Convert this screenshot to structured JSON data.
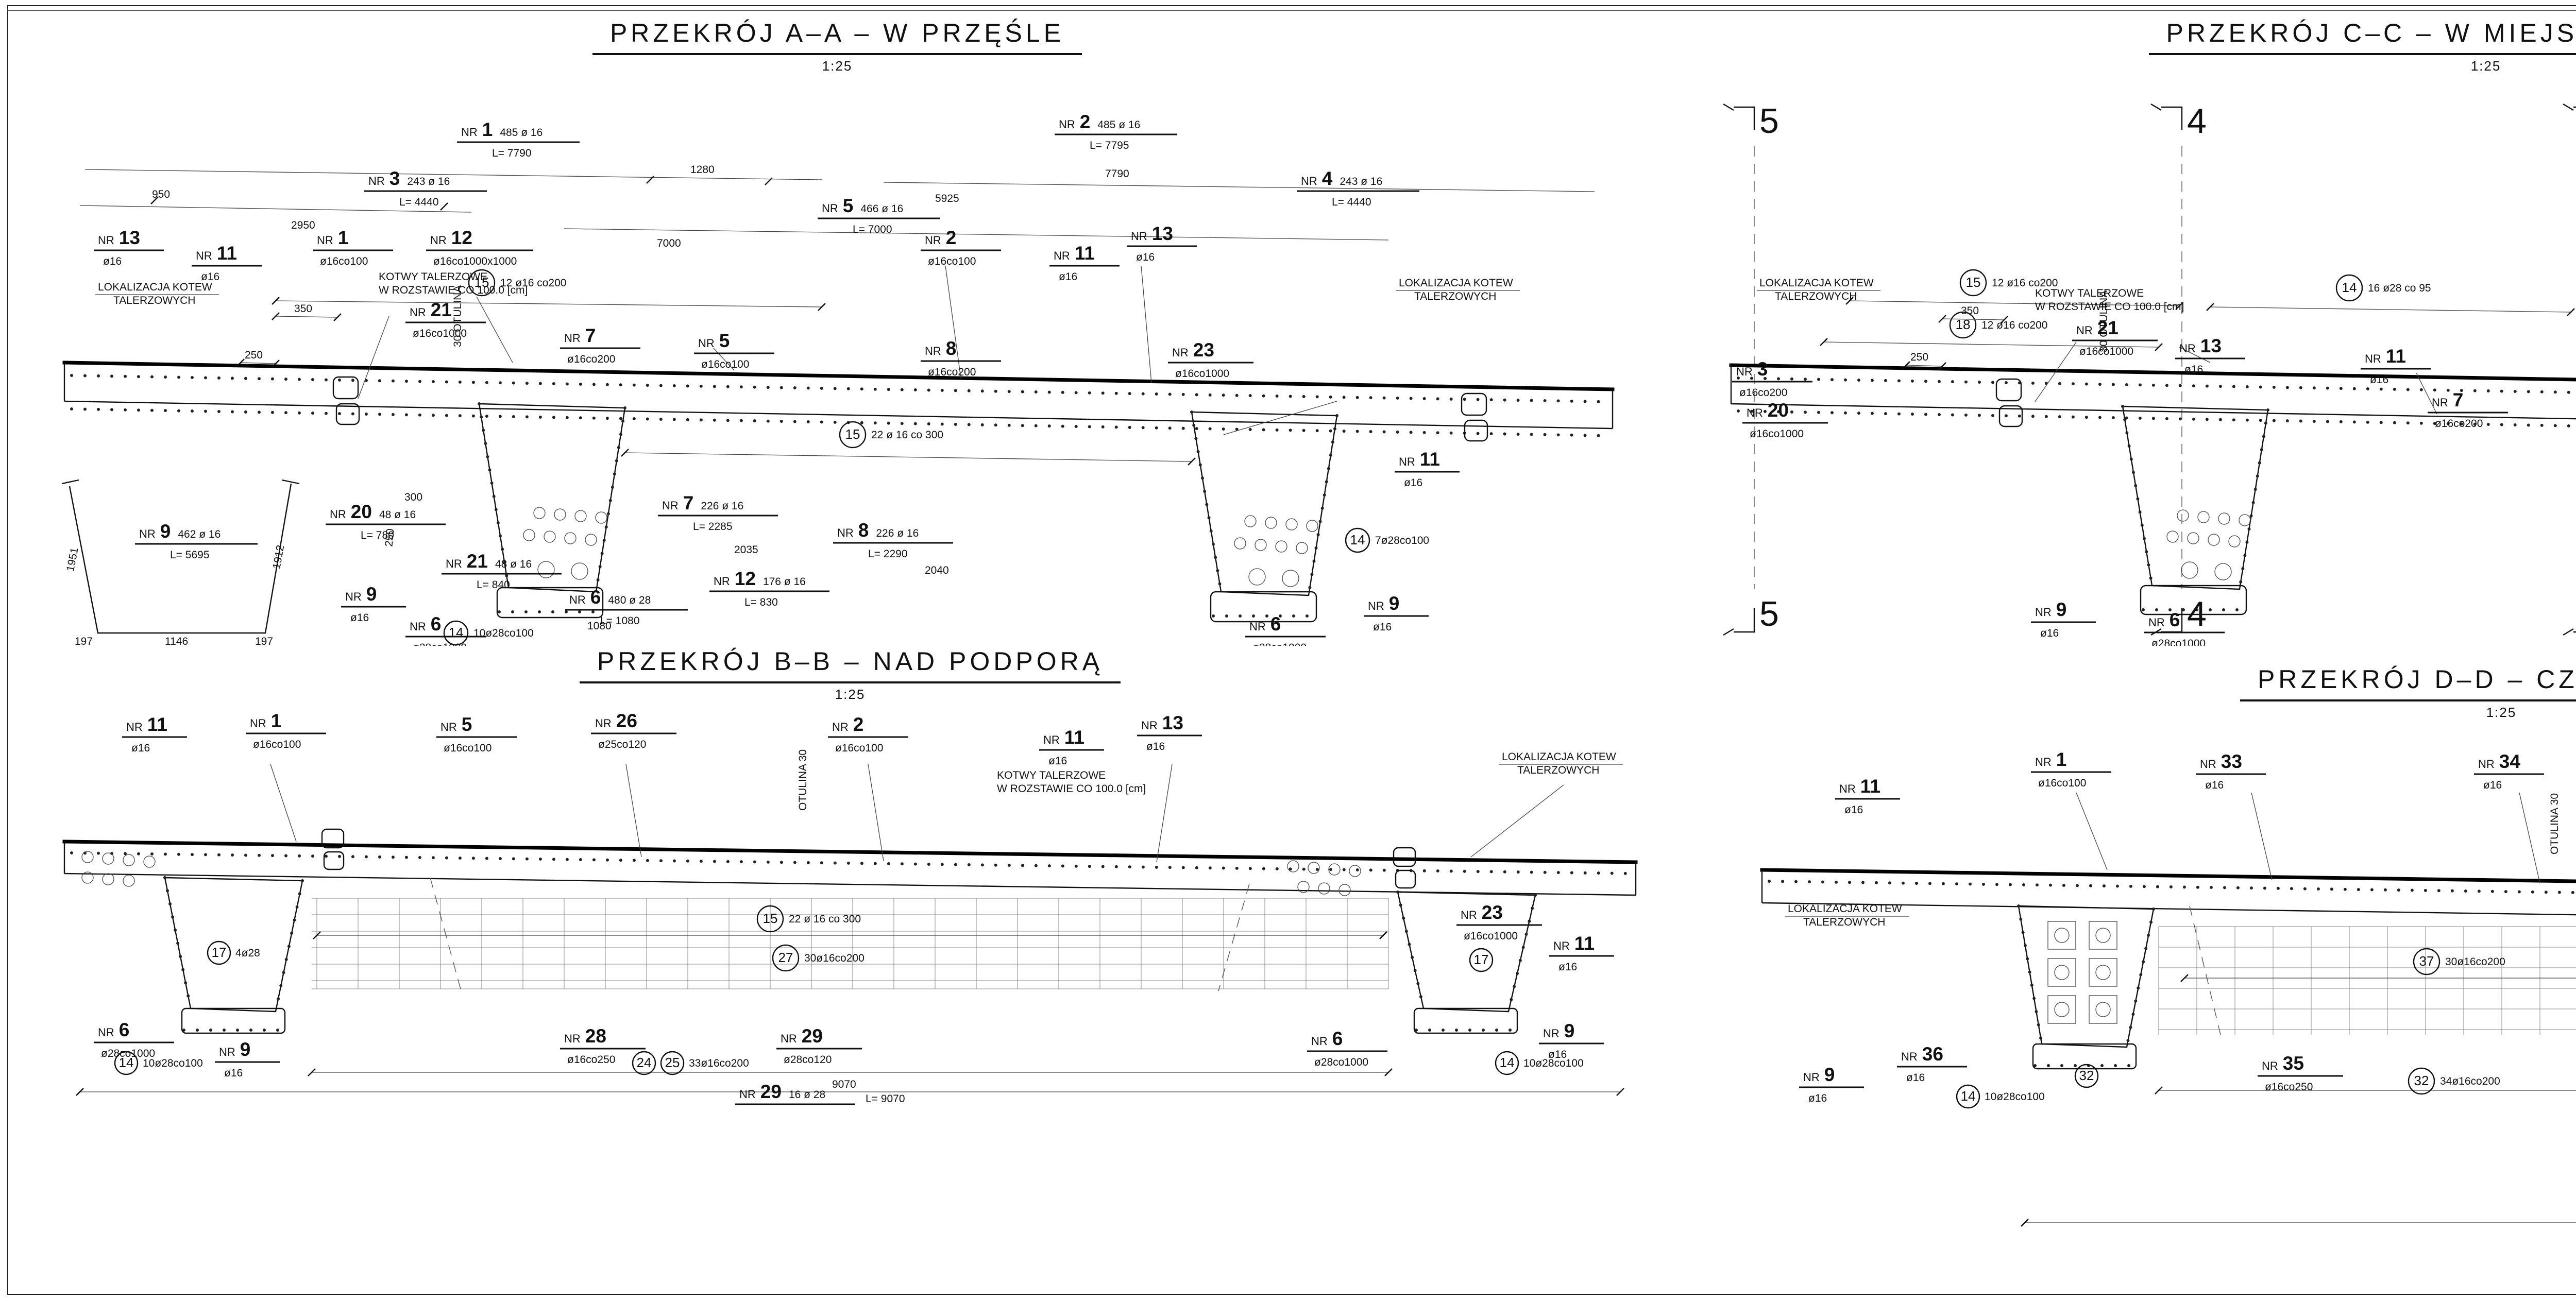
{
  "labels": {
    "nr": "NR"
  },
  "sections": {
    "aa": {
      "title": "PRZEKRÓJ A–A – W PRZĘŚLE",
      "scale": "1:25",
      "bars": [
        {
          "no": "1",
          "qty": "485 ø 16",
          "len": "L= 7790"
        },
        {
          "no": "2",
          "qty": "485 ø 16",
          "len": "L= 7795"
        },
        {
          "no": "3",
          "qty": "243 ø 16",
          "len": "L= 4440"
        },
        {
          "no": "4",
          "qty": "243 ø 16",
          "len": "L= 4440"
        },
        {
          "no": "5",
          "qty": "466 ø 16",
          "len": "L= 7000"
        }
      ],
      "callouts": [
        {
          "no": "13",
          "spec": "ø16"
        },
        {
          "no": "11",
          "spec": "ø16"
        },
        {
          "no": "1",
          "spec": "ø16co100"
        },
        {
          "no": "12",
          "spec": "ø16co1000x1000"
        },
        {
          "no": "2",
          "spec": "ø16co100"
        },
        {
          "no": "11",
          "spec": "ø16"
        },
        {
          "no": "13",
          "spec": "ø16"
        },
        {
          "no": "21",
          "spec": "ø16co1000"
        },
        {
          "no": "7",
          "spec": "ø16co200"
        },
        {
          "no": "5",
          "spec": "ø16co100"
        },
        {
          "no": "8",
          "spec": "ø16co200"
        },
        {
          "no": "23",
          "spec": "ø16co1000"
        },
        {
          "no": "6",
          "spec": "ø28co1000"
        },
        {
          "no": "9",
          "spec": "ø16"
        },
        {
          "no": "6",
          "spec": "ø28co1000"
        },
        {
          "no": "9",
          "spec": "ø16"
        },
        {
          "no": "11",
          "spec": "ø16"
        }
      ],
      "shapes": [
        {
          "no": "9",
          "qty": "462 ø 16",
          "len": "L= 5695"
        },
        {
          "no": "20",
          "qty": "48 ø 16",
          "len": "L= 780"
        },
        {
          "no": "21",
          "qty": "48 ø 16",
          "len": "L= 840"
        },
        {
          "no": "6",
          "qty": "480 ø 28",
          "len": "L= 1080"
        },
        {
          "no": "12",
          "qty": "176 ø 16",
          "len": "L= 830"
        },
        {
          "no": "7",
          "qty": "226 ø 16",
          "len": "L= 2285"
        },
        {
          "no": "8",
          "qty": "226 ø 16",
          "len": "L= 2290"
        }
      ],
      "bubbles": [
        {
          "n": "15",
          "s": "12 ø16 co200"
        },
        {
          "n": "15",
          "s": "22 ø 16 co 300"
        },
        {
          "n": "14",
          "s": "10ø28co100"
        },
        {
          "n": "14",
          "s": "7ø28co100"
        }
      ],
      "notes": {
        "lok1": "LOKALIZACJA KOTEW",
        "lok2": "TALERZOWYCH",
        "kot1": "KOTWY TALERZOWE",
        "kot2": "W ROZSTAWIE CO 100.0 [cm]",
        "otulina": "30 OTULINA"
      },
      "dims": [
        "350",
        "250",
        "1280",
        "5925",
        "950",
        "2950",
        "7790",
        "7000",
        "1951",
        "1912",
        "1146",
        "197",
        "300",
        "250",
        "300",
        "1080",
        "2035",
        "2040"
      ]
    },
    "cc": {
      "title": "PRZEKRÓJ C–C – W MIEJSCU STYKU FAZ",
      "scale": "1:25",
      "cuts": [
        "5",
        "4",
        "3",
        "2",
        "1",
        "6"
      ],
      "callouts": [
        {
          "no": "3",
          "spec": "ø16co200"
        },
        {
          "no": "20",
          "spec": "ø16co1000"
        },
        {
          "no": "21",
          "spec": "ø16co1000"
        },
        {
          "no": "13",
          "spec": "ø16"
        },
        {
          "no": "11",
          "spec": "ø16"
        },
        {
          "no": "1",
          "spec": "ø16co100"
        },
        {
          "no": "2",
          "spec": "ø16co100"
        },
        {
          "no": "4",
          "spec": "ø16co200"
        },
        {
          "no": "23",
          "spec": "ø16co1000"
        },
        {
          "no": "9",
          "spec": "ø16"
        },
        {
          "no": "6",
          "spec": "ø28co1000"
        },
        {
          "no": "9",
          "spec": "ø16"
        },
        {
          "no": "6",
          "spec": "ø28co1000"
        },
        {
          "no": "7",
          "spec": "ø16co200"
        }
      ],
      "bubbles": [
        {
          "n": "15",
          "s": "12 ø16 co200"
        },
        {
          "n": "14",
          "s": "16 ø28 co 95"
        },
        {
          "n": "18",
          "s": "12 ø16 co200"
        },
        {
          "n": "15",
          "s": "12 ø16 co200"
        }
      ],
      "notes": {
        "lok1": "LOKALIZACJA KOTEW",
        "lok2": "TALERZOWYCH",
        "kot1": "KOTWY TALERZOWE",
        "kot2": "W ROZSTAWIE CO 100.0 [cm]",
        "otulina": "30 OTULINA"
      },
      "dims": [
        "350",
        "250"
      ]
    },
    "bb": {
      "title": "PRZEKRÓJ B–B – NAD PODPORĄ",
      "scale": "1:25",
      "callouts": [
        {
          "no": "11",
          "spec": "ø16"
        },
        {
          "no": "1",
          "spec": "ø16co100"
        },
        {
          "no": "5",
          "spec": "ø16co100"
        },
        {
          "no": "26",
          "spec": "ø25co120"
        },
        {
          "no": "2",
          "spec": "ø16co100"
        },
        {
          "no": "11",
          "spec": "ø16"
        },
        {
          "no": "13",
          "spec": "ø16"
        },
        {
          "no": "23",
          "spec": "ø16co1000"
        },
        {
          "no": "11",
          "spec": "ø16"
        },
        {
          "no": "6",
          "spec": "ø28co1000"
        },
        {
          "no": "9",
          "spec": "ø16"
        },
        {
          "no": "28",
          "spec": "ø16co250"
        },
        {
          "no": "29",
          "spec": "ø28co120"
        },
        {
          "no": "6",
          "spec": "ø28co1000"
        },
        {
          "no": "9",
          "spec": "ø16"
        }
      ],
      "shapes": [
        {
          "no": "29",
          "qty": "16 ø 28",
          "len": "L= 9070"
        }
      ],
      "bubbles": [
        {
          "n": "15",
          "s": "22 ø 16 co 300"
        },
        {
          "n": "27",
          "s": "30ø16co200"
        },
        {
          "n": "24",
          "s": ""
        },
        {
          "n": "25",
          "s": "33ø16co200"
        },
        {
          "n": "17",
          "s": "4ø28"
        },
        {
          "n": "17",
          "s": ""
        },
        {
          "n": "14",
          "s": "10ø28co100"
        },
        {
          "n": "14",
          "s": "10ø28co100"
        }
      ],
      "notes": {
        "lok1": "LOKALIZACJA KOTEW",
        "lok2": "TALERZOWYCH",
        "kot1": "KOTWY TALERZOWE",
        "kot2": "W ROZSTAWIE CO 100.0 [cm]",
        "otulina": "OTULINA 30"
      },
      "dims": [
        "9070"
      ]
    },
    "dd": {
      "title": "PRZEKRÓJ D–D – CZOŁO BELKI",
      "scale": "1:25",
      "callouts": [
        {
          "no": "11",
          "spec": "ø16"
        },
        {
          "no": "1",
          "spec": "ø16co100"
        },
        {
          "no": "33",
          "spec": "ø16"
        },
        {
          "no": "34",
          "spec": "ø16"
        },
        {
          "no": "2",
          "spec": "ø16co100"
        },
        {
          "no": "34A",
          "spec": "ø16"
        },
        {
          "no": "11",
          "spec": "ø16"
        },
        {
          "no": "36",
          "spec": "ø16"
        },
        {
          "no": "9",
          "spec": "ø16"
        },
        {
          "no": "35",
          "spec": "ø16co250"
        },
        {
          "no": "36",
          "spec": "ø16"
        },
        {
          "no": "6",
          "spec": "ø28co1000"
        }
      ],
      "bubbles": [
        {
          "n": "37",
          "s": "30ø16co200"
        },
        {
          "n": "32",
          "s": "34ø16co200"
        },
        {
          "n": "32",
          "s": ""
        },
        {
          "n": "14",
          "s": "10ø28co100"
        },
        {
          "n": "14",
          "s": "10ø28co100"
        }
      ],
      "notes": {
        "lok1": "LOKALIZACJA KOTEW",
        "lok2": "TALERZOWYCH",
        "kot1": "KOTWY TALERZOWE",
        "kot2": "W ROZSTAWIE CO 100.0 [cm]",
        "otulina": "OTULINA 30"
      },
      "dims": [
        "9070"
      ]
    }
  },
  "legend": {
    "title": "LEGENDA / UWAGI:",
    "lines": [
      "1. Niniejszy rysunek rozpatrywać łącznie z całą dokumentacją",
      "2. Integralną częścią dokumentacji jest opis oraz specyfikacje",
      "techniczne wykonania i odbioru robót"
    ]
  },
  "project_note": {
    "lines": [
      "PROJEKT POWSTAŁ NA PODSTAWIE DOKUMENTACJI SPORZĄDZONEJ",
      "PRZEZ WBP W ZABRZU WYKONANEJ PRZEZ PROJEKTANTA",
      "PANIĄ inż. EWĘ AUGUSTYNOWICZ"
    ]
  },
  "titleblock": {
    "company": {
      "name": "MOSTY",
      "city": "KATOWICE",
      "address": [
        "40–555 Katowice",
        "ul. Rolna 12",
        "www.mosty.katowice.pl",
        "e-mail: biuro@mosty.katowice.pl"
      ]
    },
    "inwestor": {
      "label": "INWESTOR:",
      "lines": [
        "DROGOWA TRASA ŚREDNICOWA SPÓŁKA AKCYJNA",
        "UL. MIESZKA I NR 10, 40–877 KATOWICE 22"
      ]
    },
    "zadanie": {
      "label": "ZADANIE:",
      "lines": [
        "BUDOWA DROGI PUBLICZNEJ",
        "DROGOWEJ TRASY ŚREDNICOWEJ KATOWICE – GLIWICE,",
        "CZĘŚĆ \"ZACHÓD\" OD UL. BAILDONA W GLIWICACH DO TERENU MIASTA ZABRZE",
        "OD KM 4+037,37 DO KM 5+320,00  (ODCINEK NR G2/4)"
      ]
    },
    "nr_zadania": {
      "label": "NR ZADANIA:",
      "value": "402100655_6951"
    },
    "stadium": {
      "label": "STADIUM:",
      "value": "PROJEKT WYKONAWCZY"
    },
    "branza": {
      "label": "BRANŻA:",
      "value": "INŻYNIERYJNA"
    },
    "obiekt": {
      "label": "OBIEKT:",
      "value": "MOST Gm1–2 W CIĄGU DTŚ NAD RZEKĄ KŁODNICĄ"
    },
    "tytul": {
      "label": "TYTUŁ RYSUNKU:",
      "lines": [
        "RYSUNEK ZBROJENIOWY–PRZĘSŁA–",
        "SEGMENTY 1L ORAZ 1P"
      ]
    },
    "rysunek": {
      "label": "RYSUNEK NR:",
      "no": "I",
      "sheet": "35"
    },
    "skala": {
      "label": "SKALA:",
      "value": "1:25"
    },
    "data": {
      "label": "DATA:",
      "line1": "MAJ",
      "line2": "2011"
    },
    "people": [
      {
        "label": "PROJEKTANT:",
        "name": "MGR INŻ. CZESŁAW POŁEDNIOK",
        "cert": [
          "UW-144/97",
          "do projektowania i kierowania",
          "robotami budowlanymi",
          "bez ograniczeń w specjalności",
          "konstrukcyjno-budowlanej"
        ]
      },
      {
        "label": "ZESPÓŁ PROJEKTOWY:",
        "name": "MGR INŻ. JACEK GŁODEK",
        "cert": [
          "UW-425/01",
          "do projektowania",
          "bez ograniczeń w specjalności",
          "konstrukcyjno-budowlanej"
        ]
      },
      {
        "label": "",
        "name": "MGR INŻ. KRZYSZTOF MARKOWICZ",
        "cert": [
          "UW-638/02",
          "do projektowania",
          "bez ograniczeń w specjalności",
          "konstrukcyjno-budowlanej"
        ]
      },
      {
        "label": "",
        "name": "MGR INŻ. DARIUSZ SZYMANEK",
        "cert": [
          "UW-424/01",
          "do projektowania",
          "bez ograniczeń w specjalności",
          "konstrukcyjno-budowlanej"
        ]
      },
      {
        "label": "SPRAWDZAJĄCY:",
        "name": "MGR INŻ. MACIEJ FIDYK",
        "cert": [
          "SLK/1392/POOM/06",
          "do projektowania bez ograniczeń",
          "w specjalności mostowej"
        ]
      },
      {
        "label": "AUTOR OPRACOWANIA:",
        "name": "MGR JACEK ŻUR",
        "cert": []
      }
    ]
  },
  "arkusz": [
    {
      "t": "ARKUSZ",
      "n": "1z3"
    },
    {
      "t": "ARKUSZ",
      "n": "2z3"
    },
    {
      "t": "ARKUSZ",
      "n": "3z3"
    }
  ]
}
